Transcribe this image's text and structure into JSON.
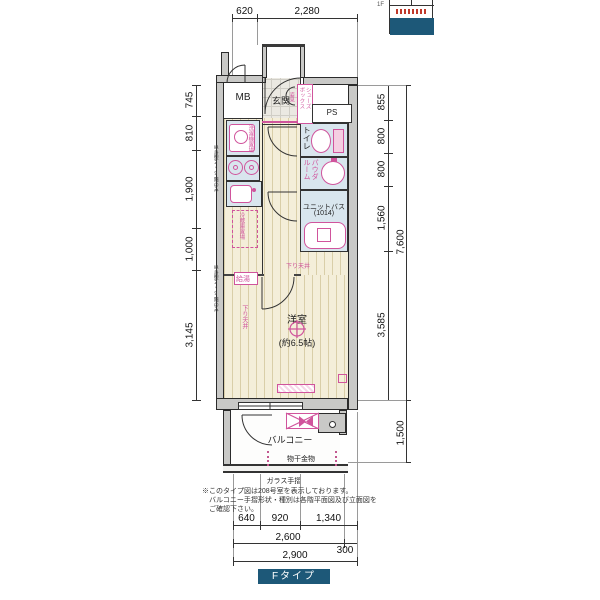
{
  "colors": {
    "accent_pink": "#d0549c",
    "room_blue": "#d9e6ee",
    "wood": "#f4eed9",
    "wall_gray": "#c9c9c7",
    "type_teal": "#1d5878"
  },
  "inset": {
    "floor_label": "1F"
  },
  "dims": {
    "top": [
      "620",
      "2,280"
    ],
    "left": [
      "745",
      "810",
      "1,900",
      "1,000",
      "3,145"
    ],
    "right": [
      "855",
      "800",
      "800",
      "1,560",
      "3,585"
    ],
    "right_total": "7,600",
    "balcony_depth": "1,500",
    "bottom_row1": [
      "640",
      "920",
      "1,340"
    ],
    "bottom_row2": [
      "2,600",
      "300"
    ],
    "bottom_total": "2,900"
  },
  "rooms": {
    "mb": "MB",
    "genkan": "玄関",
    "ps": "PS",
    "toilet": "トイレ",
    "powder": "パウダ\nルーム",
    "unit_bath_l1": "ユニットバス",
    "unit_bath_l2": "(1014)",
    "main_name": "洋室",
    "main_size": "(約6.5帖)",
    "balcony": "バルコニー"
  },
  "labels": {
    "shoe_box": "シューズ\nボックス",
    "mirror": "姿見",
    "washer": "洗濯機置場",
    "fridge": "冷蔵庫置場",
    "water_heater": "給湯",
    "down_ceiling_v": "下り天井",
    "down_ceiling_h": "下り天井",
    "laundry_hardware": "物干金物",
    "glass_rail": "ガラス手摺",
    "floor_note": "単身型2〜9階のみ",
    "type": "Fタイプ"
  },
  "notes": [
    "※このタイプ図は208号室を表示しております。",
    "バルコニー手摺形状・種別は各階平面図及び立面図を",
    "ご確認下さい。"
  ]
}
